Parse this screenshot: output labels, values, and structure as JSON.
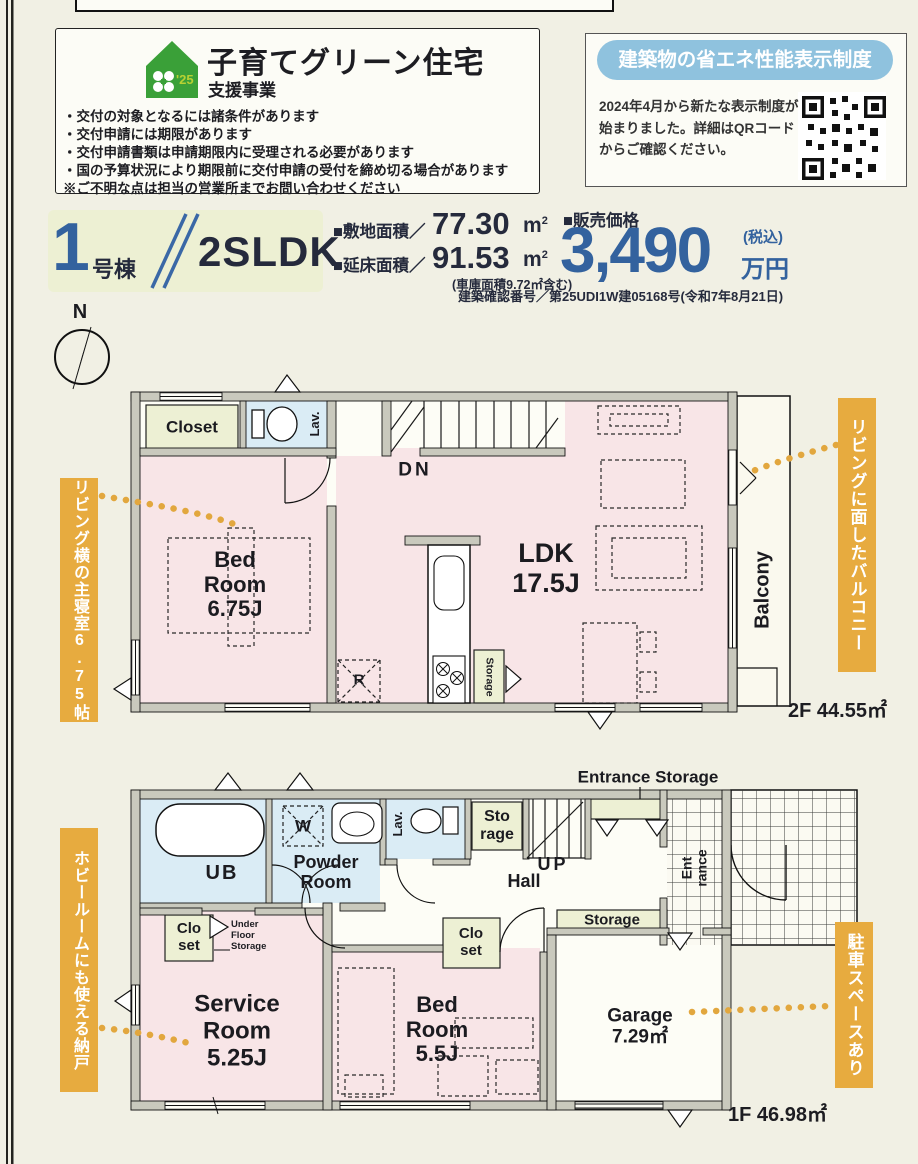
{
  "subsidy_box": {
    "icon_year": "'25",
    "title": "子育てグリーン住宅",
    "subtitle": "支援事業",
    "notes": [
      "・交付の対象となるには諸条件があります",
      "・交付申請には期限があります",
      "・交付申請書類は申請期限内に受理される必要があります",
      "・国の予算状況により期限前に交付申請の受付を締め切る場合があります",
      "※ご不明な点は担当の営業所までお問い合わせください"
    ]
  },
  "energy_box": {
    "header": "建築物の省エネ性能表示制度",
    "body": "2024年4月から新たな表示制度が\n始まりました。詳細はQRコード\nからご確認ください。"
  },
  "listing": {
    "unit_number": "1",
    "unit_label": "号棟",
    "plan_type": "2SLDK",
    "site_area_label": "■敷地面積／",
    "site_area_value": "77.30",
    "floor_area_label": "■延床面積／",
    "floor_area_value": "91.53",
    "area_unit": "m",
    "area_unit_sup": "2",
    "garage_note": "(車庫面積9.72㎡含む)",
    "price_label": "■販売価格",
    "price_value": "3,490",
    "price_tax": "(税込)",
    "price_unit": "万円",
    "confirmation": "建築確認番号／第25UDI1W建05168号(令和7年8月21日)"
  },
  "compass": {
    "north": "N"
  },
  "floor2": {
    "closet": "Closet",
    "lav": "Lav.",
    "bedroom": "Bed\nRoom\n6.75J",
    "dn": "DN",
    "ldk": "LDK\n17.5J",
    "fridge": "R",
    "storage": "Storage",
    "balcony": "Balcony",
    "area": "2F 44.55㎡"
  },
  "floor1": {
    "ub": "UB",
    "washer": "W",
    "powder": "Powder\nRoom",
    "lav": "Lav.",
    "storage_room": "Sto\nrage",
    "up": "UP",
    "hall": "Hall",
    "entrance_storage": "Entrance Storage",
    "entrance": "Ent\nrance",
    "storage_strip": "Storage",
    "closet_left": "Clo\nset",
    "underfloor": "Under\nFloor\nStorage",
    "closet_mid": "Clo\nset",
    "service": "Service\nRoom\n5.25J",
    "bedroom": "Bed\nRoom\n5.5J",
    "garage": "Garage\n7.29㎡",
    "area": "1F 46.98㎡"
  },
  "callouts": {
    "bedroom2f": "リビング横の主寝室6.75帖",
    "balcony2f": "リビングに面したバルコニー",
    "storage1f": "ホビールームにも使える納戸",
    "parking1f": "駐車スペースあり"
  }
}
